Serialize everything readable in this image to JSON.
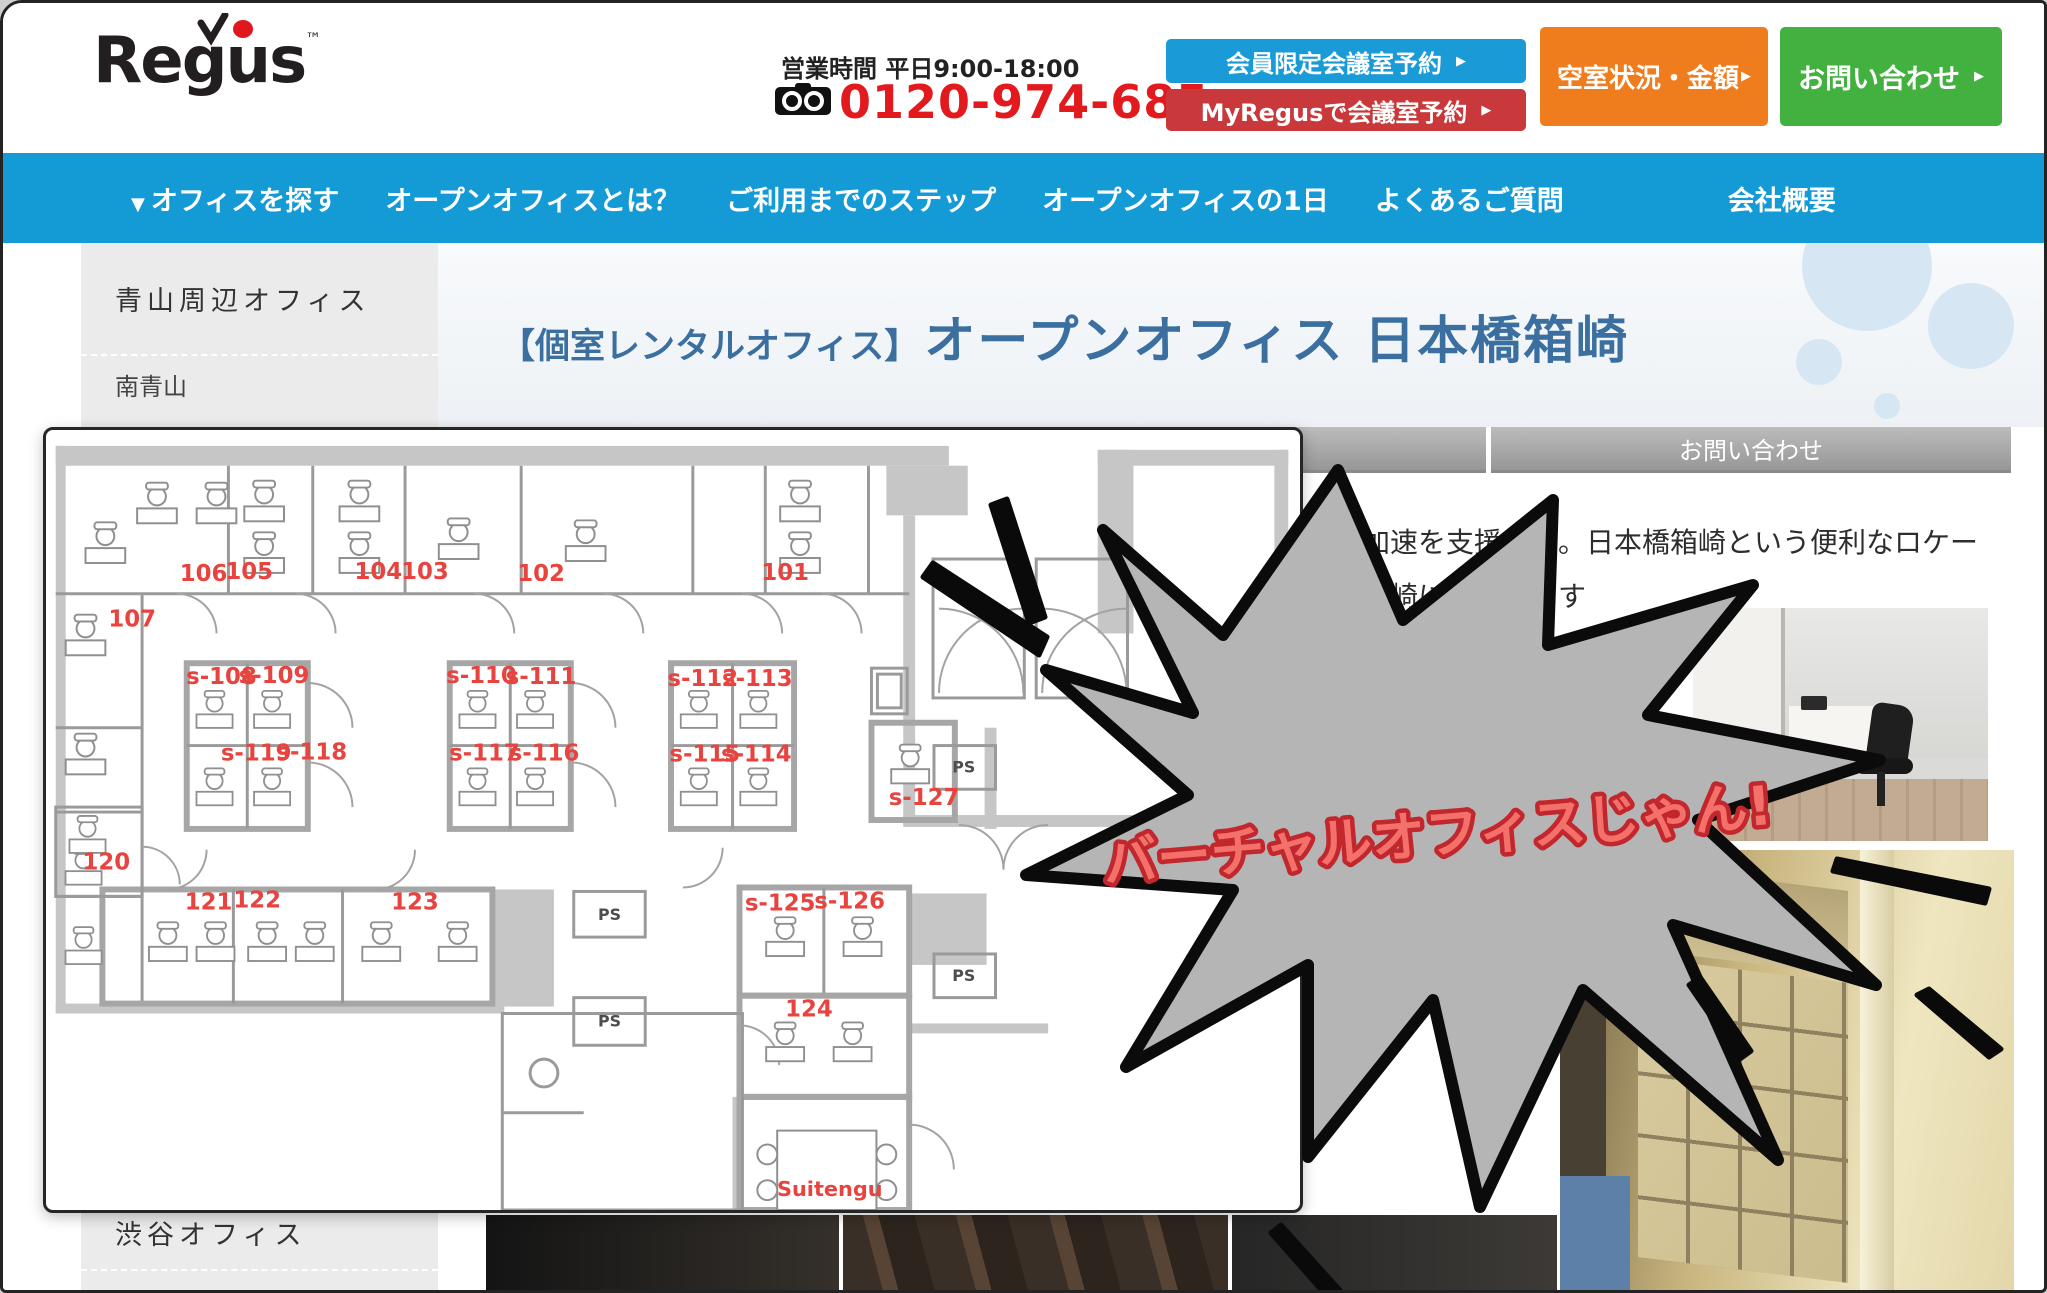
{
  "header": {
    "logo_text": "Regus",
    "logo_tm": "™",
    "logo_dot_color": "#e0181e",
    "hours_label": "営業時間 平日9:00-18:00",
    "phone": "0120-974-685",
    "phone_color": "#e2191d",
    "buttons": [
      {
        "label": "会員限定会議室予約",
        "arrow": "▶",
        "bg": "#1a9bd7"
      },
      {
        "label": "MyRegusで会議室予約",
        "arrow": "▶",
        "bg": "#c9393b"
      },
      {
        "label": "空室状況・金額",
        "arrow": "▶",
        "bg": "#ef7c1d"
      },
      {
        "label": "お問い合わせ",
        "arrow": "▶",
        "bg": "#43b13f"
      }
    ]
  },
  "nav": {
    "bg": "#149bd6",
    "caret": "▼",
    "items": [
      "オフィスを探す",
      "オープンオフィスとは？",
      "ご利用までのステップ",
      "オープンオフィスの1日",
      "よくあるご質問",
      "会社概要"
    ]
  },
  "sidebar": {
    "header": "青山周辺オフィス",
    "items": [
      "南青山",
      "青山セントラル"
    ],
    "bottom_header": "渋谷オフィス"
  },
  "content": {
    "title_prefix": "【個室レンタルオフィス】",
    "title_main": "オープンオフィス 日本橋箱崎",
    "title_color": "#3a6fa0",
    "tab_contact": "お問い合わせ",
    "body_line1": "スの加速を支援する。日本橋箱崎という便利なロケー",
    "body_line2": "本橋箱崎にはあります"
  },
  "burst": {
    "text": "バーチャルオフィスじゃん!",
    "fill": "#b5b5b5",
    "stroke": "#0b0b0b",
    "text_color": "#f4716b",
    "text_outline": "#c1272d"
  },
  "floorplan": {
    "accent": "#e8433e",
    "ps_label": "PS",
    "annotation": "Suitengu",
    "annotation_x": 788,
    "annotation_y": 772,
    "rooms": [
      {
        "label": "106",
        "x": 157,
        "y": 152
      },
      {
        "label": "105",
        "x": 203,
        "y": 150
      },
      {
        "label": "104",
        "x": 333,
        "y": 150
      },
      {
        "label": "103",
        "x": 380,
        "y": 150
      },
      {
        "label": "102",
        "x": 497,
        "y": 152
      },
      {
        "label": "101",
        "x": 743,
        "y": 151
      },
      {
        "label": "107",
        "x": 85,
        "y": 198
      },
      {
        "label": "s-108",
        "x": 175,
        "y": 256
      },
      {
        "label": "s-109",
        "x": 228,
        "y": 255
      },
      {
        "label": "s-110",
        "x": 437,
        "y": 255
      },
      {
        "label": "s-111",
        "x": 497,
        "y": 256
      },
      {
        "label": "s-112",
        "x": 660,
        "y": 258
      },
      {
        "label": "s-113",
        "x": 715,
        "y": 258
      },
      {
        "label": "s-119",
        "x": 210,
        "y": 333
      },
      {
        "label": "s-118",
        "x": 266,
        "y": 332
      },
      {
        "label": "s-117",
        "x": 440,
        "y": 333
      },
      {
        "label": "s-116",
        "x": 500,
        "y": 333
      },
      {
        "label": "s-115",
        "x": 662,
        "y": 334
      },
      {
        "label": "s-114",
        "x": 714,
        "y": 334
      },
      {
        "label": "120",
        "x": 59,
        "y": 443
      },
      {
        "label": "121",
        "x": 162,
        "y": 483
      },
      {
        "label": "122",
        "x": 211,
        "y": 481
      },
      {
        "label": "123",
        "x": 370,
        "y": 483
      },
      {
        "label": "s-125",
        "x": 738,
        "y": 484
      },
      {
        "label": "s-126",
        "x": 808,
        "y": 482
      },
      {
        "label": "124",
        "x": 767,
        "y": 591
      },
      {
        "label": "s-127",
        "x": 883,
        "y": 378
      }
    ],
    "ps": [
      {
        "x": 566,
        "y": 494
      },
      {
        "x": 566,
        "y": 601
      },
      {
        "x": 923,
        "y": 345
      },
      {
        "x": 923,
        "y": 555
      }
    ]
  }
}
